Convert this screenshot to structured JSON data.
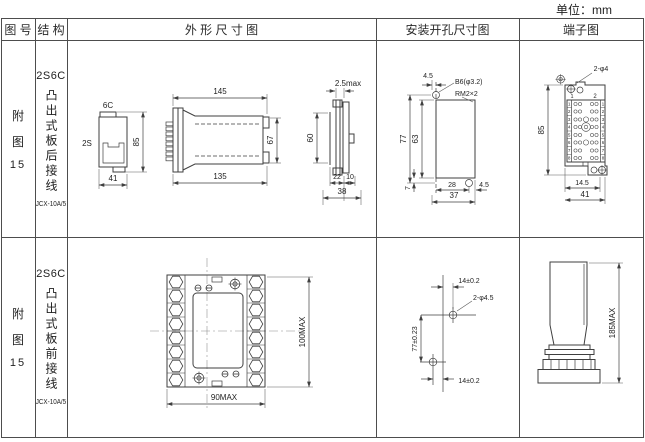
{
  "unit_label": "单位：mm",
  "header": {
    "drawing_no": "图 号",
    "structure": "结 构",
    "outline": "外 形 尺 寸 图",
    "mounting": "安装开孔尺寸图",
    "terminal": "端子图"
  },
  "rows": [
    {
      "fig_char1": "附",
      "fig_char2": "图",
      "fig_num": "15",
      "model": "2S6C",
      "type_vertical": "凸出式板后接线",
      "subtype": "JCX-10A/5",
      "outline": {
        "front_top": "6C",
        "front_left": "2S",
        "front_height": "85",
        "front_width": "41",
        "side_top": "145",
        "side_bottom": "135",
        "side_right": "67",
        "panel_top": "2.5max",
        "panel_height": "60",
        "panel_w1": "22",
        "panel_w2": "10",
        "panel_total": "38"
      },
      "mounting": {
        "top_offset": "4.5",
        "hole_label": "B6(φ3.2)",
        "thread_label": "RM2×2",
        "height_total": "77",
        "height_inner": "63",
        "bottom_offset": "7",
        "width_inner": "28",
        "right_offset": "4.5",
        "width_total": "37"
      },
      "terminal": {
        "holes_label": "2-φ4",
        "col1": "1",
        "col2": "2",
        "height": "85",
        "width_inner": "14.5",
        "width_total": "41",
        "rownums": [
          "1",
          "2",
          "3",
          "4",
          "5",
          "6",
          "7",
          "8"
        ]
      }
    },
    {
      "fig_char1": "附",
      "fig_char2": "图",
      "fig_num": "15",
      "model": "2S6C",
      "type_vertical": "凸出式板前接线",
      "subtype": "JCX-10A/5",
      "outline": {
        "width": "90MAX",
        "height": "100MAX"
      },
      "mounting": {
        "top_offset": "14±0.2",
        "holes_label": "2-φ4.5",
        "height": "77±0.23",
        "bottom_offset": "14±0.2"
      },
      "terminal": {
        "height": "185MAX"
      }
    }
  ]
}
